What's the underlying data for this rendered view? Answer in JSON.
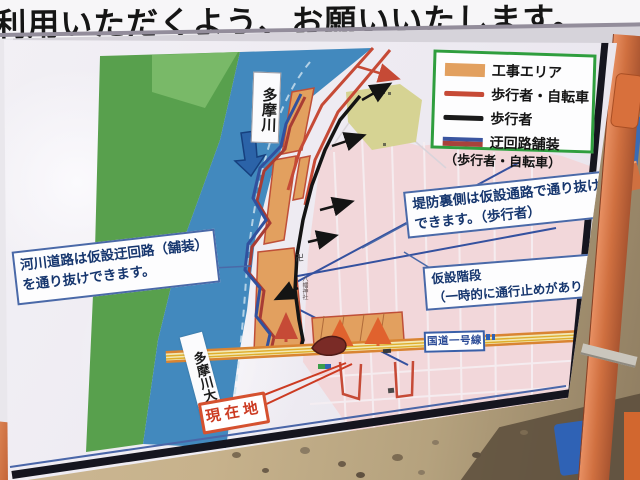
{
  "banner": {
    "text": "利用いただくよう、お願いいたします。"
  },
  "legend": {
    "items": [
      {
        "label": "工事エリア"
      },
      {
        "label": "歩行者・自転車"
      },
      {
        "label": "歩行者"
      },
      {
        "label": "迂回路舗装",
        "label2": "（歩行者・自転車）"
      }
    ]
  },
  "callouts": {
    "river_road": "河川道路は仮設迂回路（舗装）を通り抜けできます。",
    "levee_back": "堤防裏側は仮設通路で通り抜けできます。（歩行者）",
    "stairs": "仮設階段",
    "stairs_note": "（一時的に通行止めがあります）"
  },
  "map": {
    "river": "多摩川",
    "bridge": "多摩川大橋",
    "route1": "国道一号線",
    "you_are_here": "現在地",
    "temple_mark": "卍",
    "shrine_text": "八幡神社"
  },
  "colors": {
    "construction_area": "#e2a05f",
    "pedestrian_bicycle": "#c64a36",
    "pedestrian": "#1a1a1a",
    "detour_paving_blue": "#31519e",
    "detour_paving_red": "#a83c34",
    "river_blue": "#4289be",
    "bank_green": "#58a04d",
    "city_pink": "#f2d7da",
    "road_orange": "#d98432",
    "legend_border_green": "#2f9e3e",
    "callout_blue": "#3c5f9e",
    "current_location_red": "#cc3b22"
  }
}
